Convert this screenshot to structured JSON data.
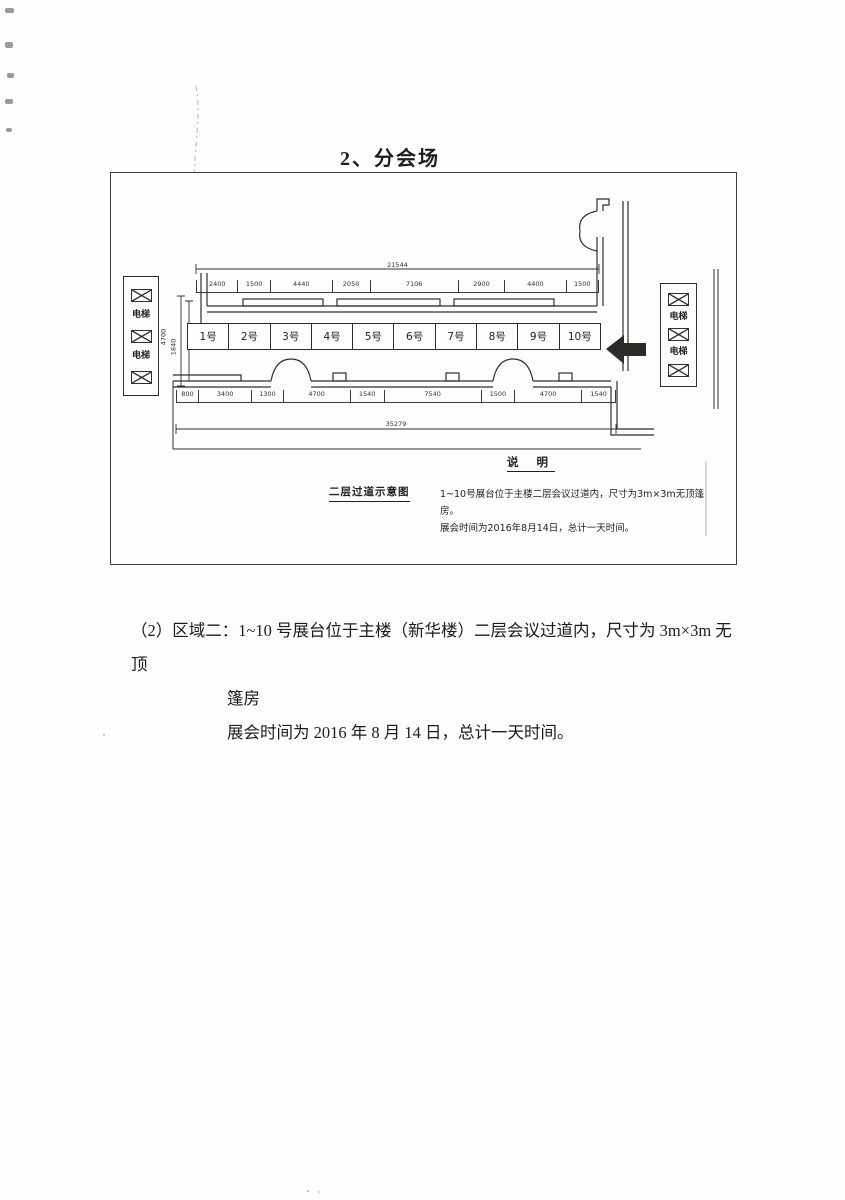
{
  "page": {
    "title": "2、分会场"
  },
  "diagram": {
    "caption": "二层过道示意图",
    "legend": {
      "title": "说  明",
      "line1": "1~10号展台位于主楼二层会议过道内，尺寸为3m×3m无顶篷房。",
      "line2": "展会时间为2016年8月14日，总计一天时间。"
    },
    "booths": [
      "1号",
      "2号",
      "3号",
      "4号",
      "5号",
      "6号",
      "7号",
      "8号",
      "9号",
      "10号"
    ],
    "elevator_label": "电梯",
    "dims": {
      "top_total": "21544",
      "top_segments": [
        "2400",
        "1500",
        "4440",
        "2050",
        "7106",
        "2900",
        "4400",
        "1500"
      ],
      "bottom_segments": [
        "800",
        "3400",
        "1300",
        "4700",
        "1540",
        "7540",
        "1500",
        "4700",
        "1540"
      ],
      "bottom_total": "35279",
      "left_vertical": [
        "4700",
        "1840"
      ]
    }
  },
  "body": {
    "line1": "（2）区域二：1~10 号展台位于主楼（新华楼）二层会议过道内，尺寸为 3m×3m 无顶",
    "line2": "篷房",
    "line3": "展会时间为 2016 年 8 月 14 日，总计一天时间。"
  }
}
